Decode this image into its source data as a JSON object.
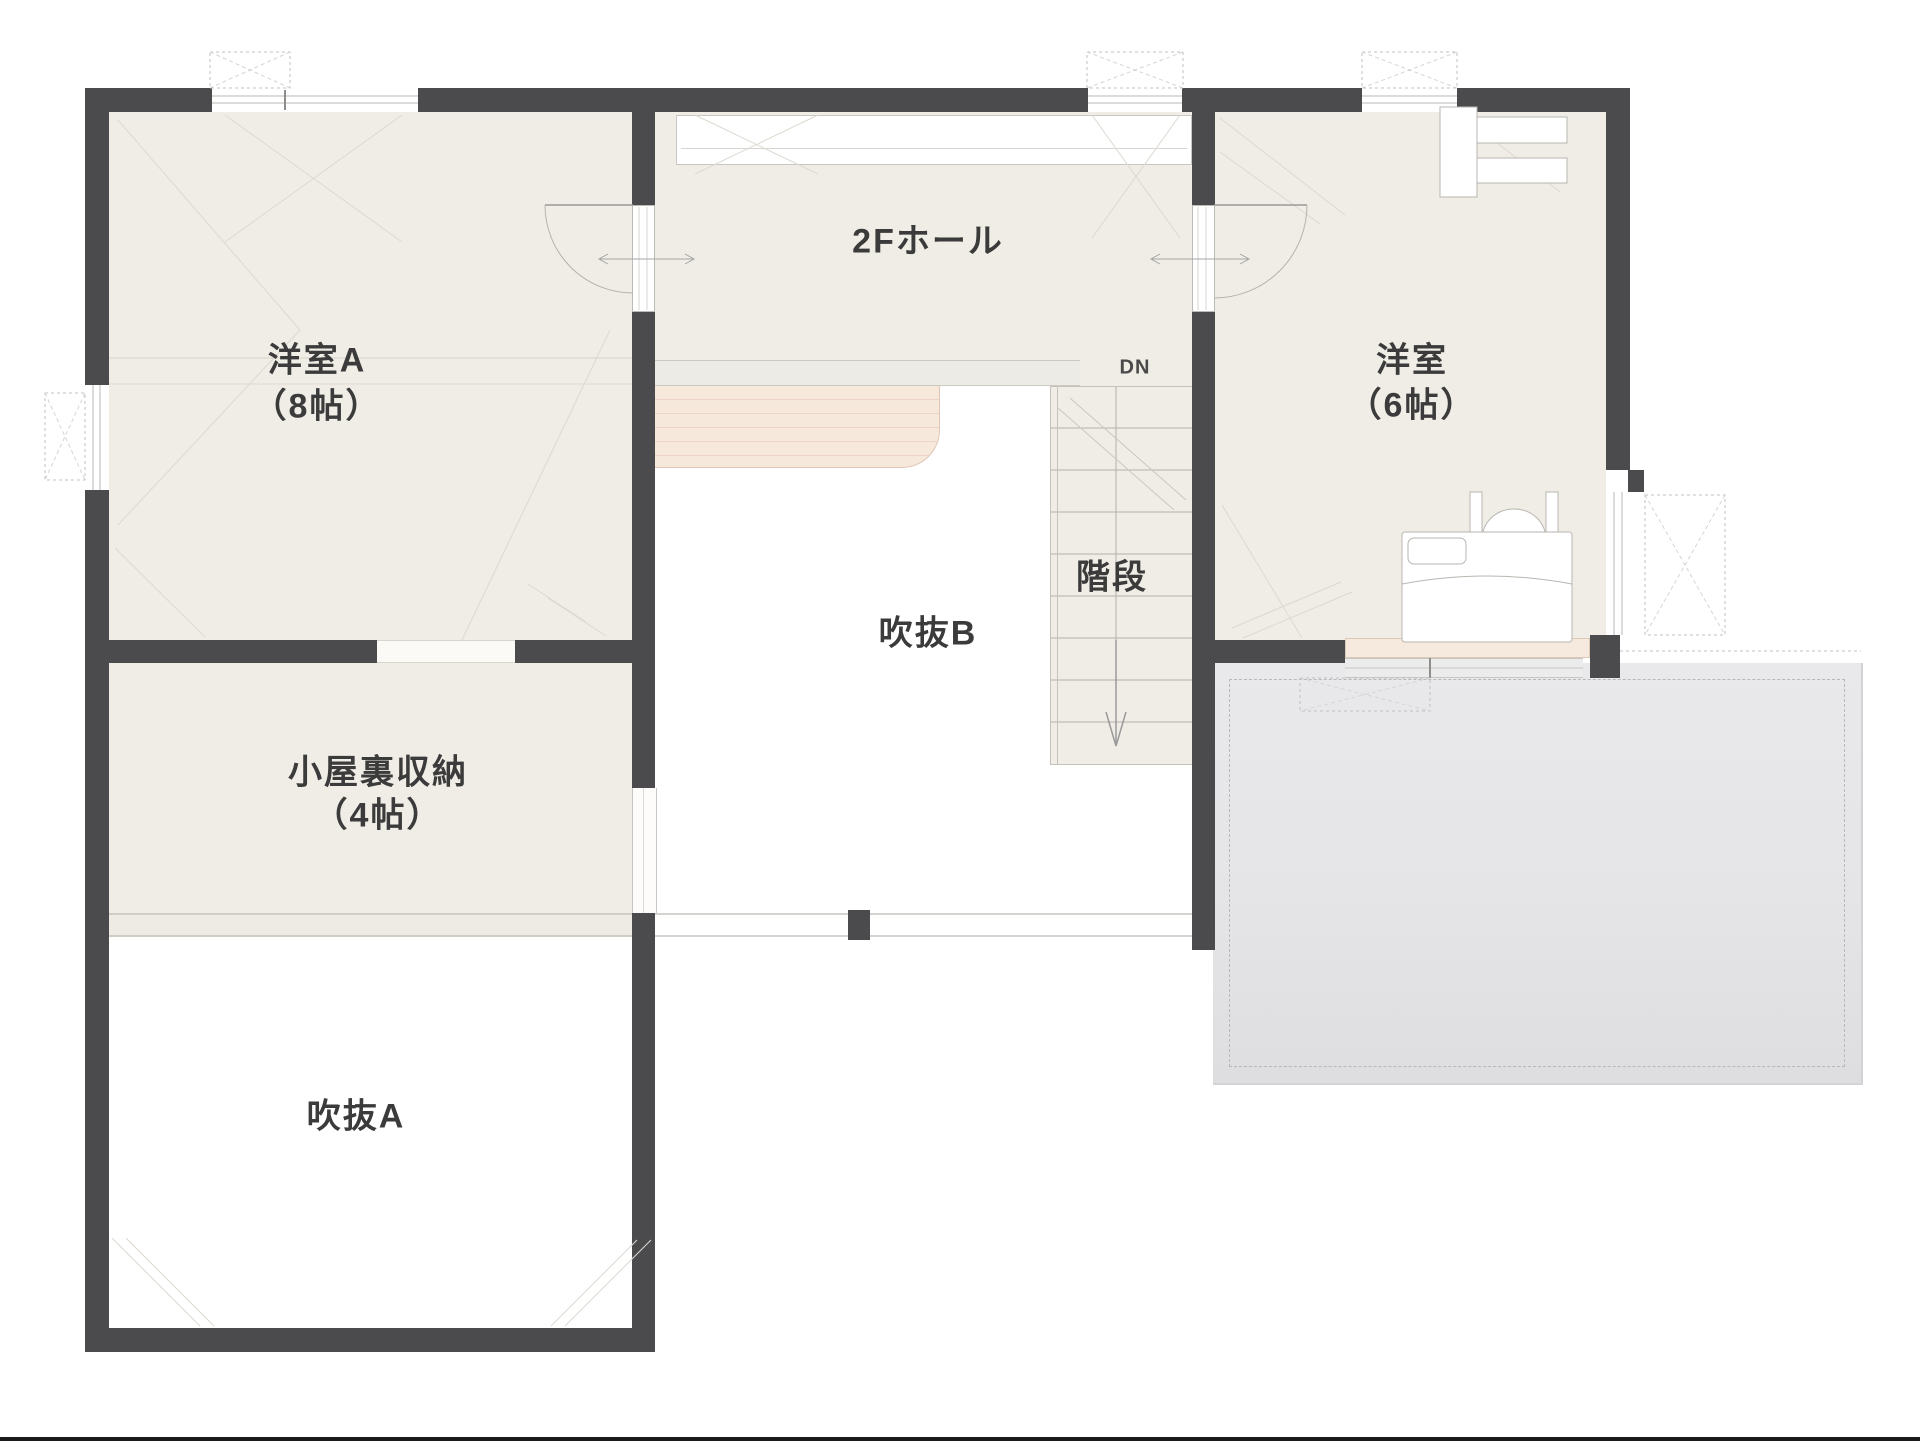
{
  "labels": {
    "room_a_name": "洋室A",
    "room_a_size": "（8帖）",
    "hall": "2Fホール",
    "dn": "DN",
    "room_b_name": "洋室",
    "room_b_size": "（6帖）",
    "stairs": "階段",
    "void_b": "吹抜B",
    "attic_name": "小屋裏収納",
    "attic_size": "（4帖）",
    "void_a": "吹抜A"
  },
  "colors": {
    "wall": "#4b4b4d",
    "floor": "#f0ede6",
    "void": "#ffffff",
    "roof_below": "#e7e7e9",
    "hatch_pink": "#f7e8dc",
    "window_sill_pink": "#f6e9dd",
    "text": "#3b3b3b"
  }
}
